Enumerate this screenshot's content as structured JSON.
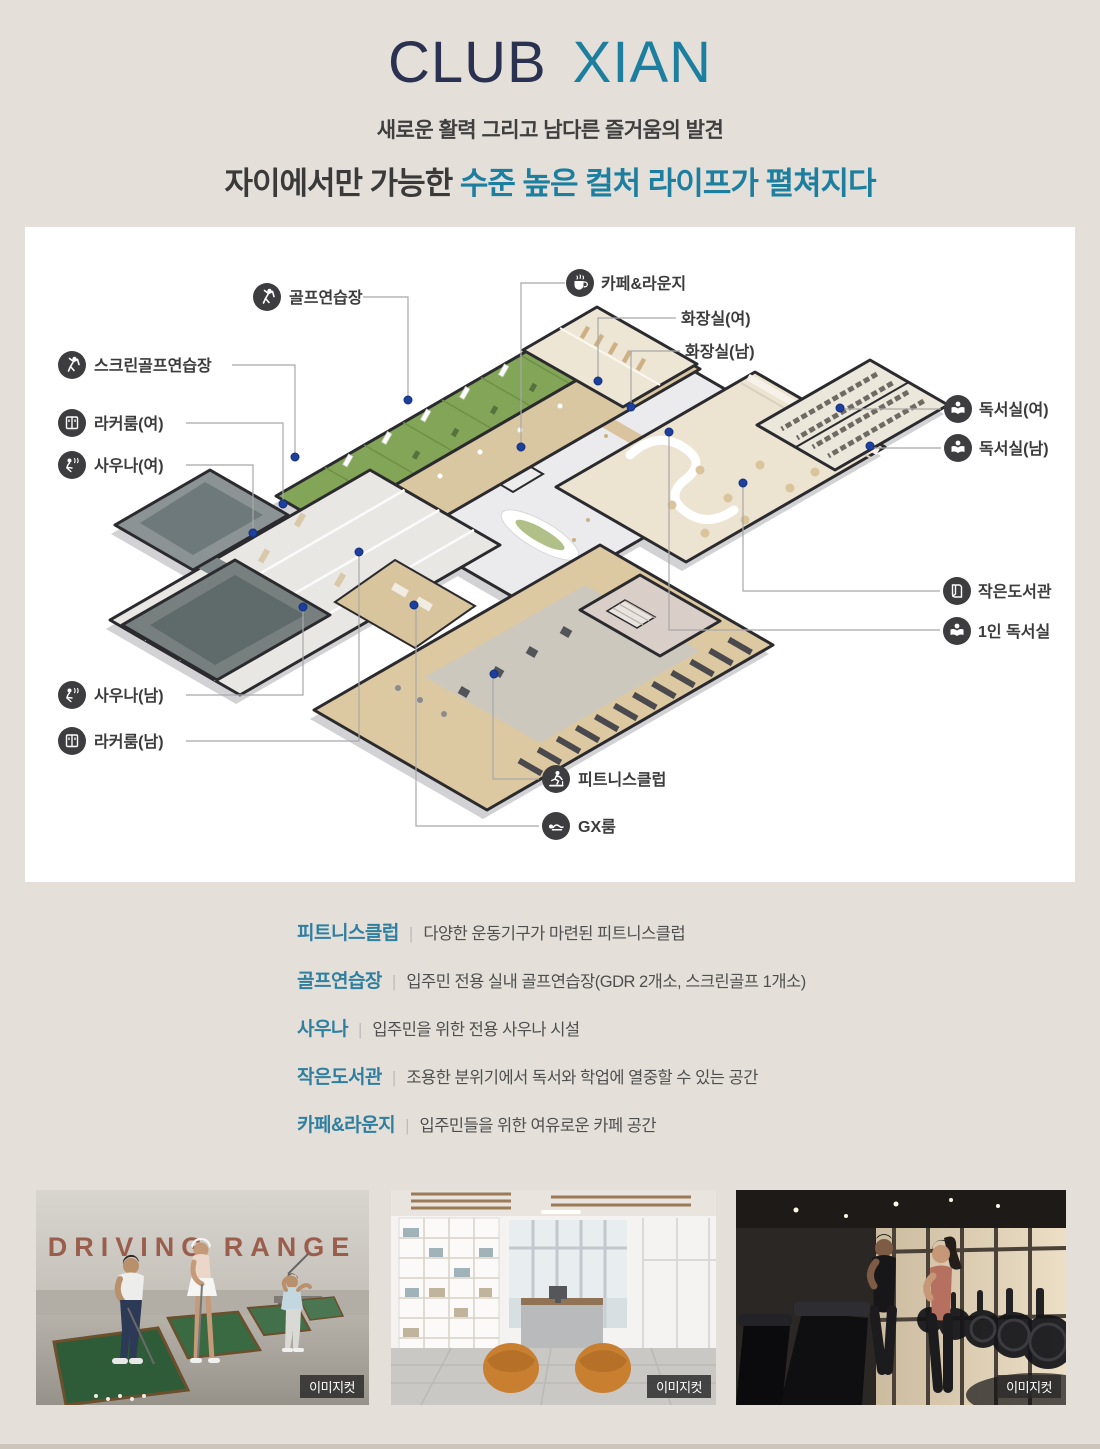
{
  "colors": {
    "bg": "#e4e0d9",
    "panel": "#ffffff",
    "accent": "#1d7f9f",
    "navy": "#2b3150",
    "icon": "#3d3d40",
    "dot": "#1e3f9e",
    "leader": "#a8a8a8",
    "label": "#3b3b3b",
    "term": "#2f7fa0",
    "desc": "#4f4f4f",
    "strip": "#ccc5bc"
  },
  "header": {
    "title_primary": "CLUB",
    "title_secondary": "XIAN",
    "subtitle": "새로운 활력 그리고 남다른 즐거움의 발견",
    "headline_dark": "자이에서만 가능한 ",
    "headline_accent": "수준 높은 컬처 라이프가 펼쳐지다"
  },
  "plan": {
    "labels": [
      {
        "text": "골프연습장",
        "icon": "golfer"
      },
      {
        "text": "스크린골프연습장",
        "icon": "golfer"
      },
      {
        "text": "라커룸(여)",
        "icon": "locker"
      },
      {
        "text": "사우나(여)",
        "icon": "sauna"
      },
      {
        "text": "사우나(남)",
        "icon": "sauna"
      },
      {
        "text": "라커룸(남)",
        "icon": "locker"
      },
      {
        "text": "카페&라운지",
        "icon": "coffee"
      },
      {
        "text": "화장실(여)",
        "icon": "none"
      },
      {
        "text": "화장실(남)",
        "icon": "none"
      },
      {
        "text": "독서실(여)",
        "icon": "reader"
      },
      {
        "text": "독서실(남)",
        "icon": "reader"
      },
      {
        "text": "작은도서관",
        "icon": "book"
      },
      {
        "text": "1인 독서실",
        "icon": "reader"
      },
      {
        "text": "피트니스클럽",
        "icon": "treadmill"
      },
      {
        "text": "GX룸",
        "icon": "gx"
      }
    ]
  },
  "facilities_sep": "|",
  "facilities": [
    {
      "term": "피트니스클럽",
      "desc": "다양한 운동기구가 마련된 피트니스클럽"
    },
    {
      "term": "골프연습장",
      "desc": "입주민 전용 실내 골프연습장(GDR 2개소, 스크린골프 1개소)"
    },
    {
      "term": "사우나",
      "desc": "입주민을 위한 전용 사우나 시설"
    },
    {
      "term": "작은도서관",
      "desc": "조용한 분위기에서 독서와 학업에 열중할 수 있는 공간"
    },
    {
      "term": "카페&라운지",
      "desc": "입주민들을 위한 여유로운 카페 공간"
    }
  ],
  "photos": [
    {
      "badge": "이미지컷",
      "wall_text": "DRIVING RANGE"
    },
    {
      "badge": "이미지컷"
    },
    {
      "badge": "이미지컷"
    }
  ]
}
